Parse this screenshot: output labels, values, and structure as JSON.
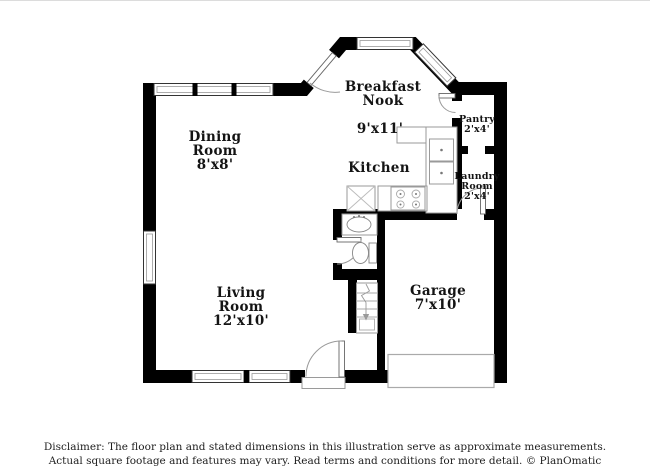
{
  "page": {
    "background": "#ffffff",
    "wall_color": "#000000"
  },
  "floorplan": {
    "rooms": {
      "breakfast_nook": {
        "line1": "Breakfast",
        "line2": "Nook",
        "dim": "9'x11'"
      },
      "kitchen": {
        "line1": "Kitchen"
      },
      "dining_room": {
        "line1": "Dining",
        "line2": "Room",
        "dim": "8'x8'"
      },
      "pantry": {
        "line1": "Pantry",
        "dim": "2'x4'"
      },
      "laundry_room": {
        "line1": "Laundry",
        "line2": "Room",
        "dim": "2'x4'"
      },
      "living_room": {
        "line1": "Living",
        "line2": "Room",
        "dim": "12'x10'"
      },
      "garage": {
        "line1": "Garage",
        "dim": "7'x10'"
      }
    },
    "fixtures": [
      "bay-window",
      "window",
      "entry-door",
      "patio-door",
      "pantry-door",
      "laundry-door",
      "bathroom-door",
      "kitchen-counter",
      "kitchen-sink",
      "stove",
      "refrigerator",
      "bathroom-sink",
      "toilet",
      "staircase",
      "garage-door",
      "entry-stoop"
    ]
  },
  "disclaimer": {
    "line1": "Disclaimer: The floor plan and stated dimensions in this illustration serve as approximate measurements.",
    "line2": "Actual square footage and features may vary. Read terms and conditions for more detail. © PlanOmatic"
  }
}
